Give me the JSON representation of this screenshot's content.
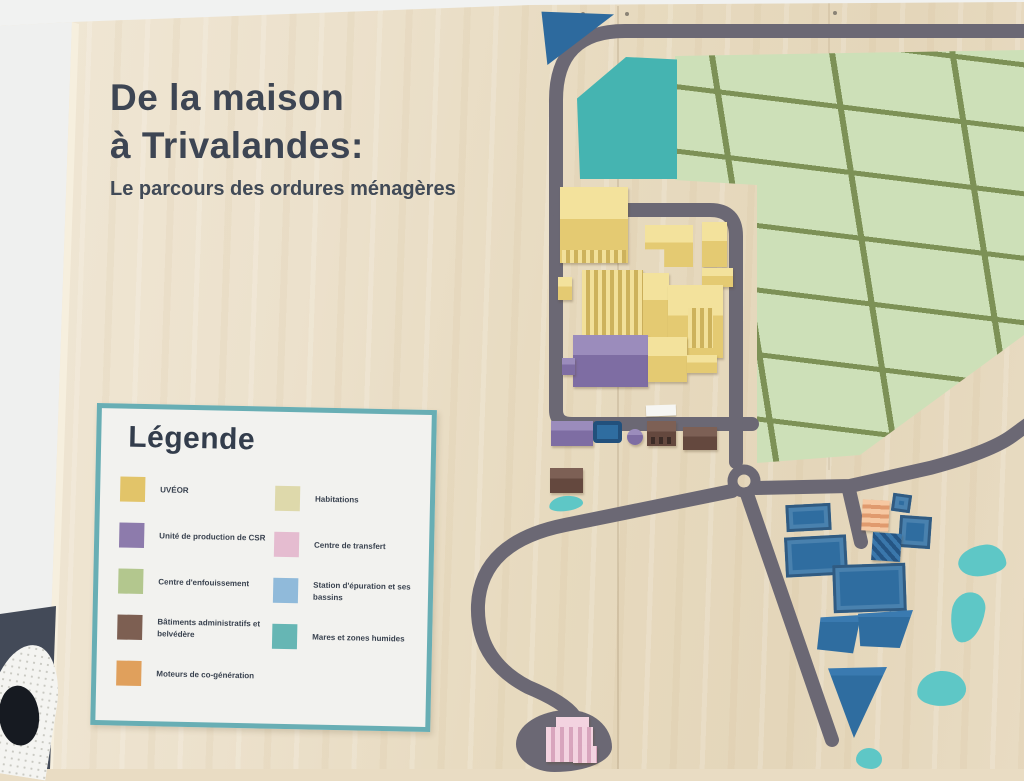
{
  "title": {
    "line1": "De la maison",
    "line2": "à Trivalandes:",
    "subtitle": "Le parcours des ordures ménagères"
  },
  "legend": {
    "title": "Légende",
    "items": [
      {
        "label": "UVÉOR",
        "color": "#e2c express"
      },
      {
        "label": "Unité de production de CSR",
        "color": "#8d7bac"
      },
      {
        "label": "Centre d'enfouissement",
        "color": "#b3c78e"
      },
      {
        "label": "Bâtiments administratifs et belvédère",
        "color": "#7d5f52"
      },
      {
        "label": "Moteurs de co-génération",
        "color": "#e0a05c"
      },
      {
        "label": "Habitations",
        "color": "#ded9ab"
      },
      {
        "label": "Centre de transfert",
        "color": "#e5bcd0"
      },
      {
        "label": "Station d'épuration et ses bassins",
        "color": "#90bada"
      },
      {
        "label": "Mares et zones humides",
        "color": "#66b6b4"
      }
    ]
  },
  "colors": {
    "road": "#6b6874",
    "legend-border": "#68aeb4",
    "landfill-cell": "#cde0b8",
    "landfill-line": "#7d9156",
    "wetland": "#45b4b1",
    "pond": "#5ec7c6",
    "basin": "#2f6da0",
    "triangle-blue": "#2d6a9e",
    "uveor-yellow": "#e8d07e",
    "csr-purple": "#816fa5",
    "admin-brown": "#6d5147",
    "transfer-pink": "#eec3d4",
    "cogeneration-peach": "#f2b990"
  }
}
